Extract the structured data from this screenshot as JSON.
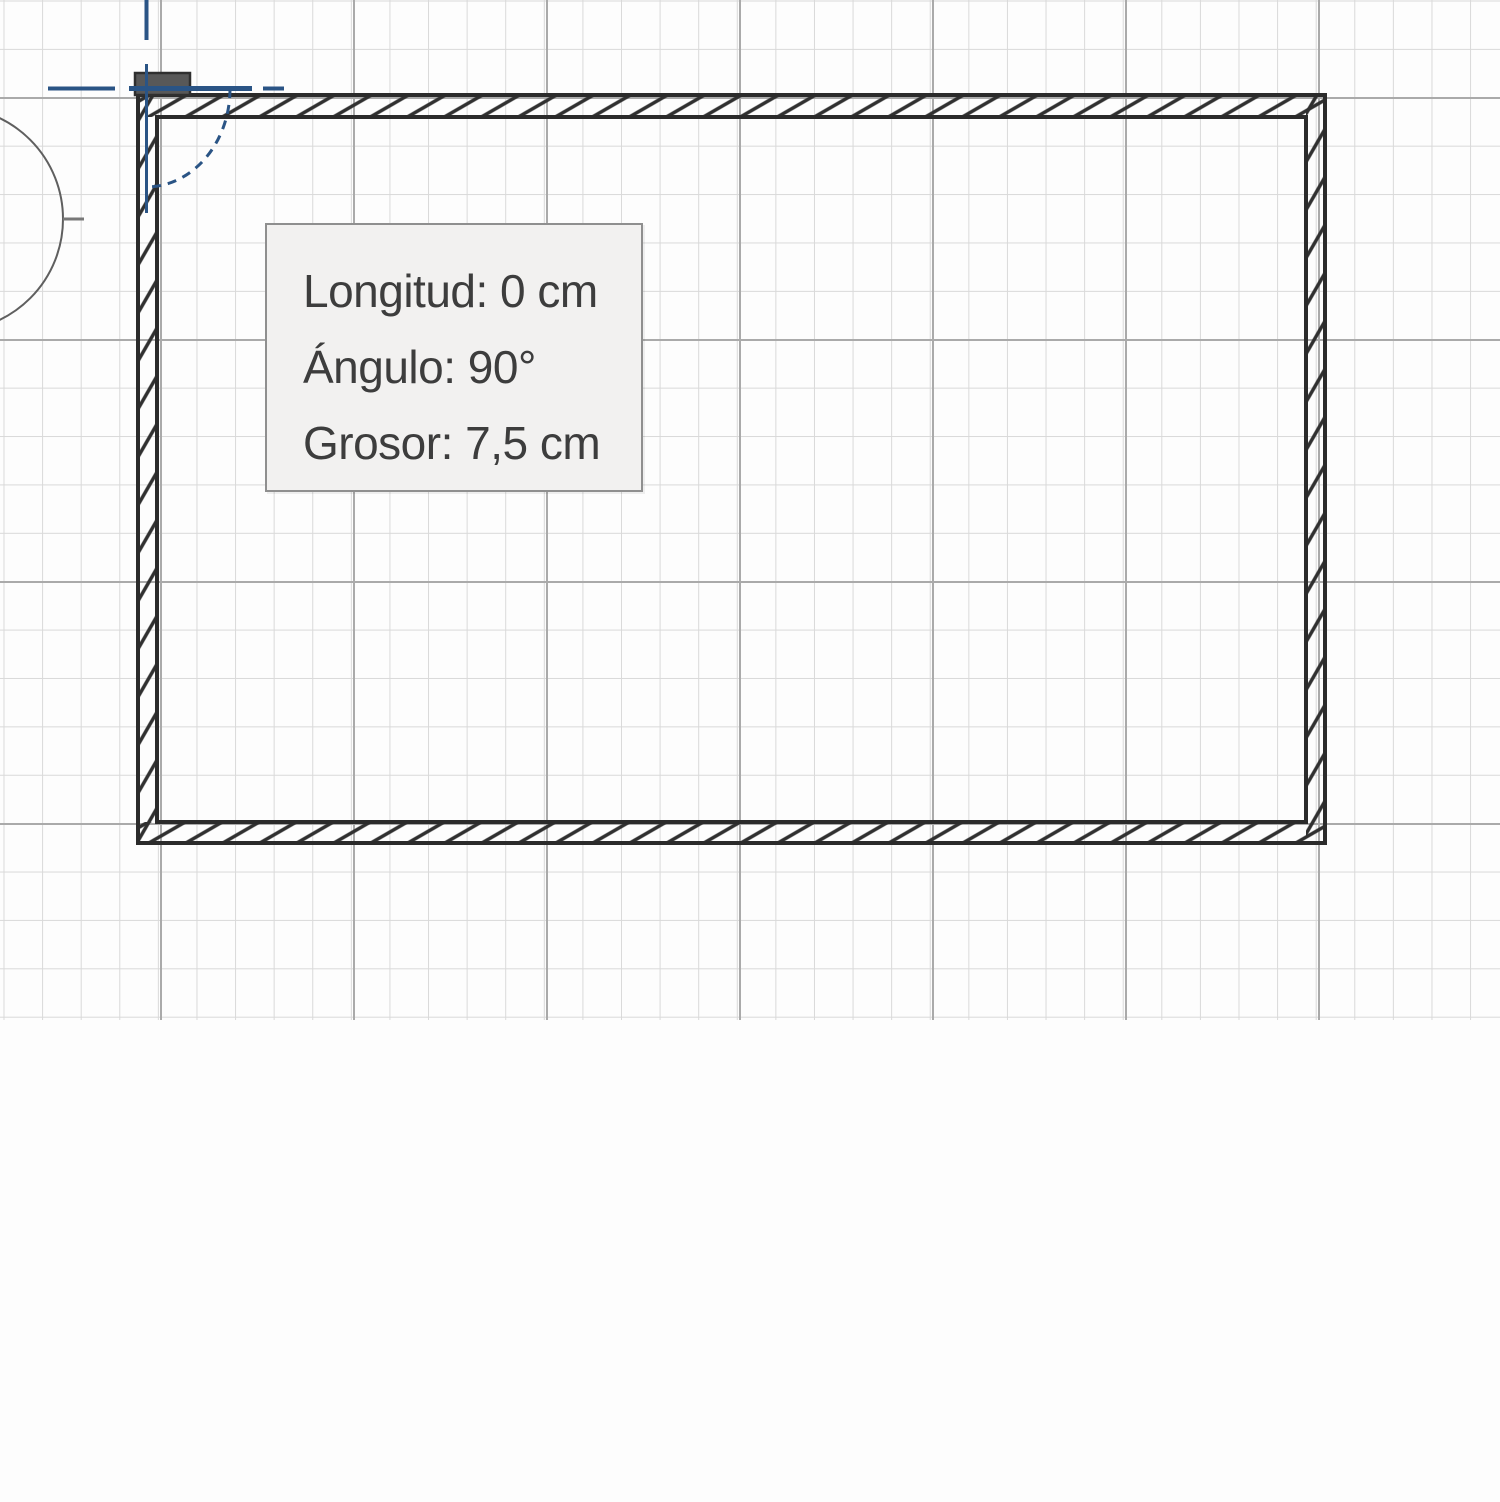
{
  "app": {
    "view": "floor-plan-canvas",
    "mode": "wall-drawing"
  },
  "tooltip": {
    "lines": [
      {
        "text": "Longitud: 0 cm",
        "label": "Longitud",
        "value": "0 cm"
      },
      {
        "text": "Ángulo: 90°",
        "label": "Ángulo",
        "value": "90°"
      },
      {
        "text": "Grosor: 7,5 cm",
        "label": "Grosor",
        "value": "7,5 cm"
      }
    ]
  },
  "measurements": {
    "length_cm": 0,
    "angle_deg": 90,
    "thickness_cm": 7.5
  },
  "colors": {
    "canvas_background": "#fdfdfd",
    "grid_minor": "#d9d9d9",
    "grid_major": "#aaaaaa",
    "wall_outline": "#2b2b2b",
    "guide_blue": "#2a5485",
    "handle_gray": "#585858",
    "tooltip_background": "#f2f1f0",
    "tooltip_border": "#8f8f8f",
    "tooltip_text": "#3d3d3d"
  },
  "icons": {
    "compass": "compass-circle-icon",
    "angle_arc": "angle-arc-indicator",
    "guides": "alignment-guide-lines"
  }
}
